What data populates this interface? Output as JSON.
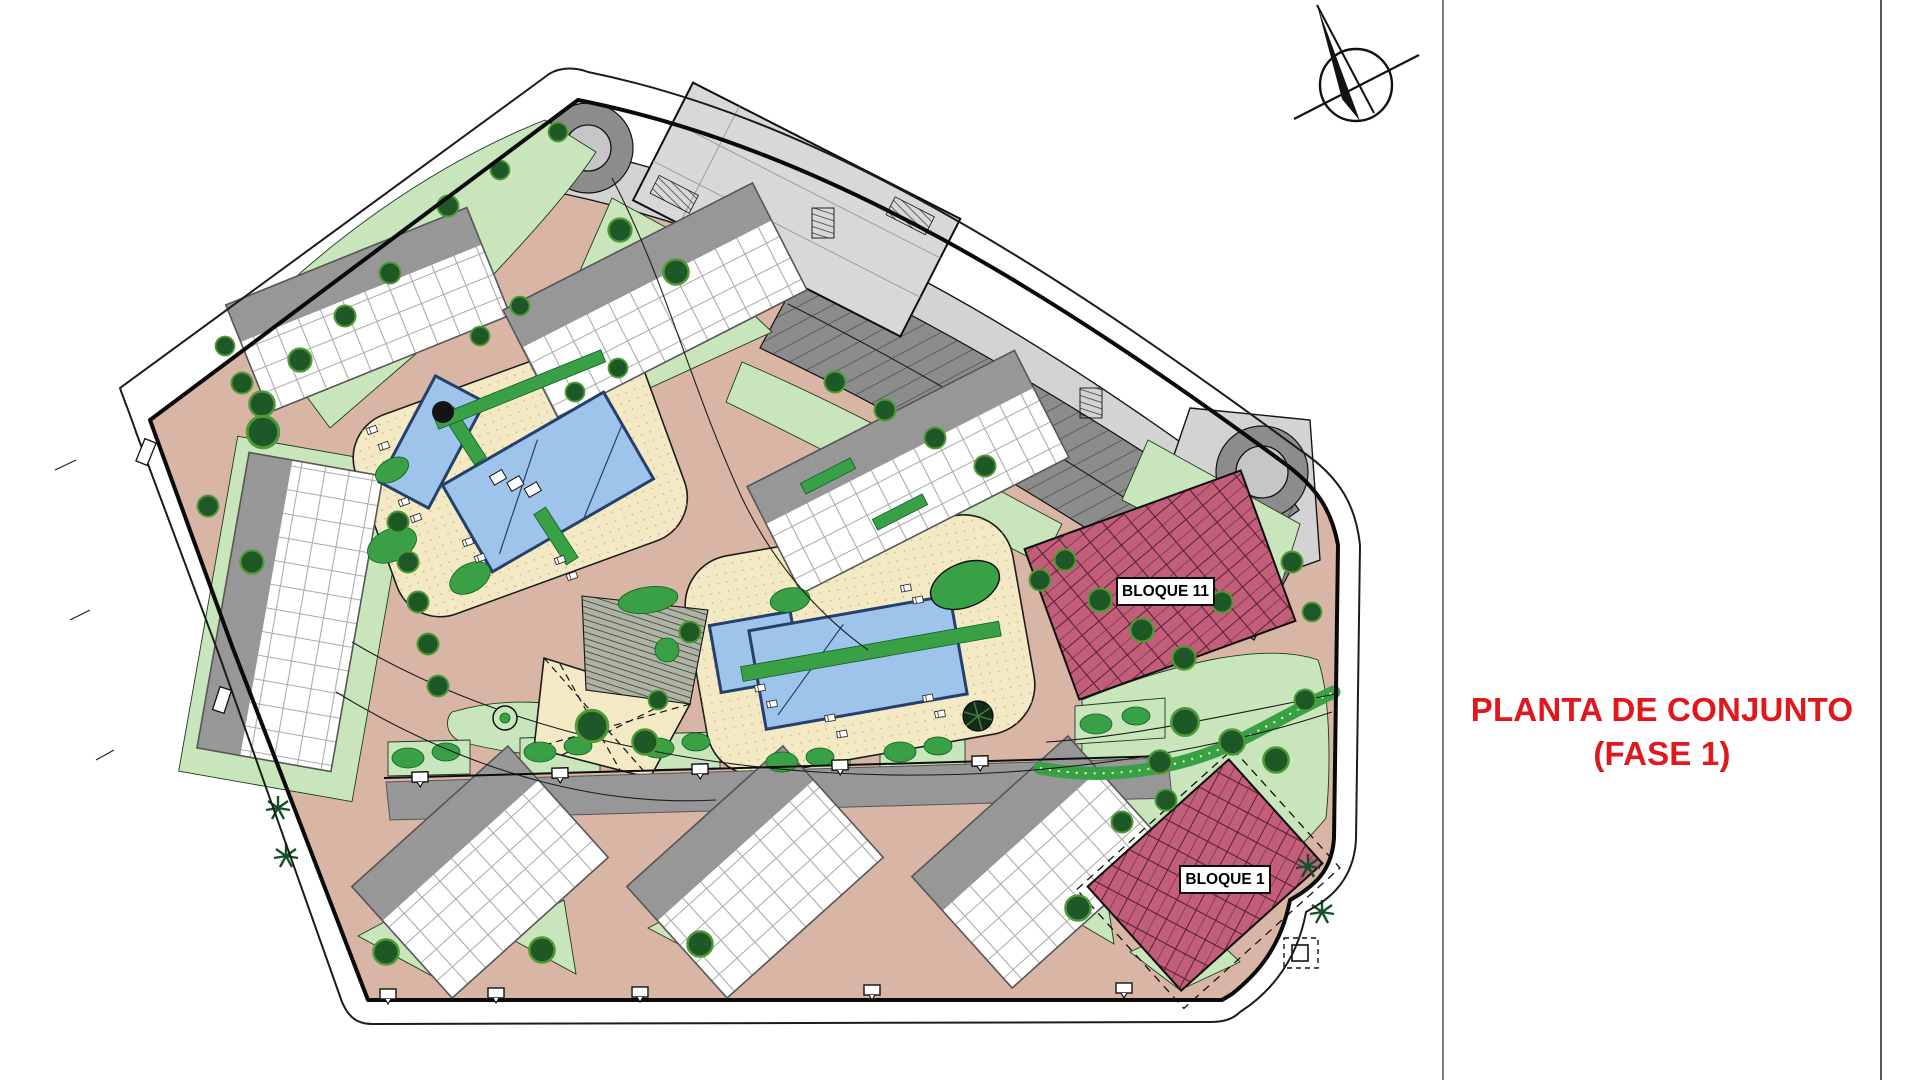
{
  "window": {
    "width": 1920,
    "height": 1080,
    "background": "#FFFFFF"
  },
  "right_panel": {
    "title_line1": "PLANTA DE CONJUNTO",
    "title_line2": "(FASE 1)",
    "title_color": "#E0181C"
  },
  "site_plan": {
    "block_labels": {
      "bloque_11": "BLOQUE 11",
      "bloque_1": "BLOQUE 1"
    },
    "compass_icon": "north-arrow",
    "palette": {
      "road": "#D9B5A5",
      "road_light": "#D3D3D3",
      "parking": "#8C8C8C",
      "lawn": "#C9E5BB",
      "hedge": "#3AA046",
      "tree": "#1E5827",
      "tree_edge": "#4F9A35",
      "deck": "#F3E9C4",
      "pool": "#9FC4EC",
      "pool_edge": "#25406B",
      "building": "#FFFFFF",
      "building_wall": "#8A8A8A",
      "roof": "#979797",
      "block_highlight": "#C25E79",
      "big_building": "#D8D8D8",
      "roundabout_center": "#C6C6C6",
      "outline": "#111111",
      "title_red": "#E0181C"
    }
  }
}
